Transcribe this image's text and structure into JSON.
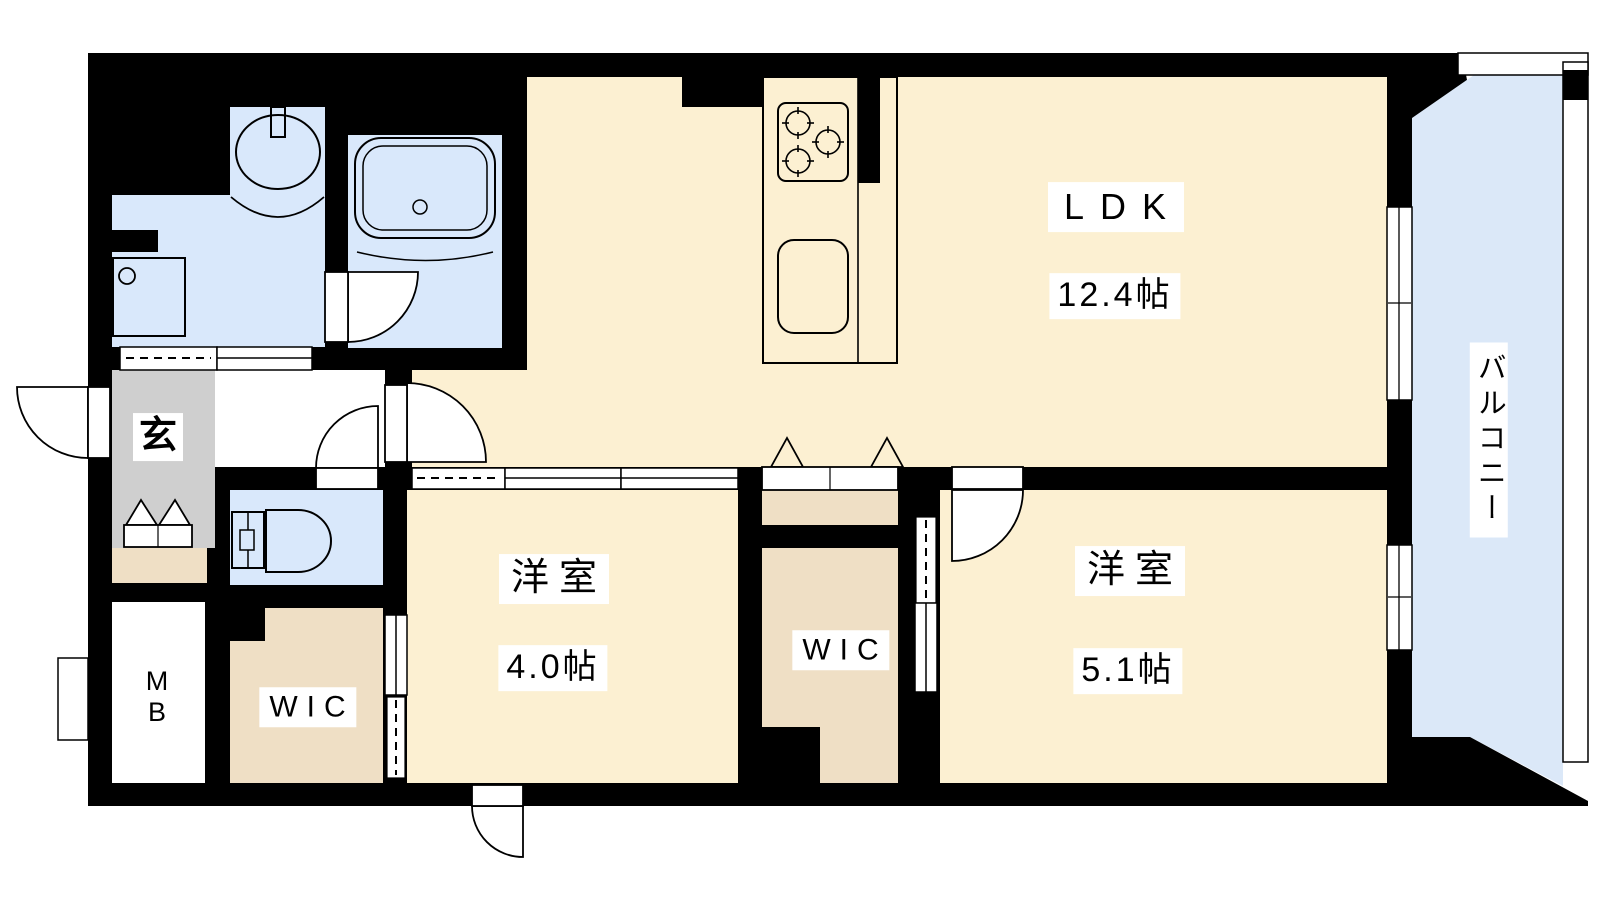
{
  "rooms": {
    "ldk": {
      "label": "LDK",
      "size": "12.4帖"
    },
    "bedroom_a": {
      "label": "洋室",
      "size": "4.0帖"
    },
    "bedroom_b": {
      "label": "洋室",
      "size": "5.1帖"
    },
    "wic_left": {
      "label": "WIC"
    },
    "wic_middle": {
      "label": "WIC"
    },
    "balcony": {
      "label": "バルコニー"
    },
    "entrance": {
      "label": "玄"
    },
    "meter_box": {
      "label": "M\nB"
    }
  },
  "colors": {
    "wall": "#000000",
    "room_floor": "#fcf0d2",
    "closet_floor": "#efdfc5",
    "wet_area": "#d9e8fb",
    "balcony_floor": "#dbe8f8",
    "entrance_floor": "#cfcfcf",
    "fixture_fill": "#ffffff",
    "label_bg": "#ffffff"
  }
}
